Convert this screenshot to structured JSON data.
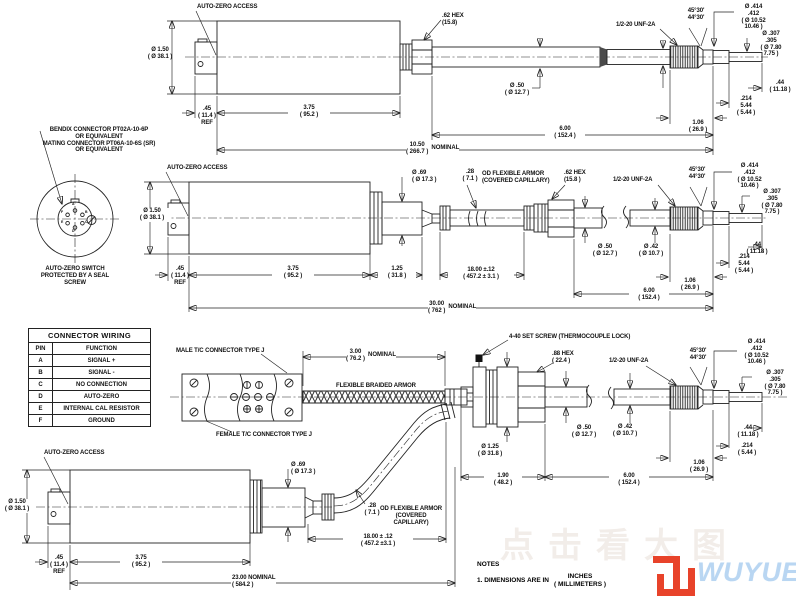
{
  "colors": {
    "line": "#222222",
    "logo_red": "#e8432a",
    "logo_blue": "#b9d6f2",
    "watermark": "#f2ede9"
  },
  "watermark": "点击看大图",
  "logo": {
    "brand": "WUYUE"
  },
  "detail": {
    "bendix": "BENDIX CONNECTOR PT02A-10-6P\nOR EQUIVALENT\nMATING CONNECTOR PT06A-10-6S (SR)\nOR EQUIVALENT",
    "caption": "AUTO-ZERO SWITCH\nPROTECTED BY A SEAL SCREW",
    "pins": [
      "A",
      "B",
      "C",
      "D",
      "E",
      "F"
    ]
  },
  "table": {
    "title": "CONNECTOR WIRING",
    "col_pin": "PIN",
    "col_function": "FUNCTION",
    "rows": [
      {
        "pin": "A",
        "fn": "SIGNAL +"
      },
      {
        "pin": "B",
        "fn": "SIGNAL -"
      },
      {
        "pin": "C",
        "fn": "NO CONNECTION"
      },
      {
        "pin": "D",
        "fn": "AUTO-ZERO"
      },
      {
        "pin": "E",
        "fn": "INTERNAL CAL RESISTOR"
      },
      {
        "pin": "F",
        "fn": "GROUND"
      }
    ]
  },
  "view1": {
    "auto_zero": "AUTO-ZERO ACCESS",
    "dia_body": "Ø 1.50\n( Ø 38.1 )",
    "ref": ".45\n( 11.4 )\nREF",
    "len_body": "3.75\n( 95.2 )",
    "hex": ".62 HEX\n(15.8)",
    "dia_50": "Ø .50\n( Ø 12.7 )",
    "thread": "1/2-20 UNF-2A",
    "dia_42": "Ø .42\n( Ø 10.7 )",
    "angle": "45°30'\n44°30'",
    "dia_tip_major": "Ø .414\n.412\n( Ø 10.52\n10.46 )",
    "dia_tip_minor": "Ø .307\n.305\n( Ø 7.80\n7.75 )",
    "len_tip": ".44\n( 11.18 )",
    "len_214": ".214\n5.44\n( 5.44 )",
    "len_thread": "1.06\n( 26.9 )",
    "len_probe": "6.00\n( 152.4 )",
    "total": "10.50\n( 266.7 )",
    "total_suffix": "NOMINAL"
  },
  "view2": {
    "auto_zero": "AUTO-ZERO ACCESS",
    "dia_body": "Ø 1.50\n( Ø 38.1 )",
    "ref": ".45\n( 11.4 )\nREF",
    "len_body": "3.75\n( 95.2 )",
    "len_adapter": "1.25\n( 31.8 )",
    "dia_adapter": "Ø .69\n( Ø 17.3 )",
    "armor_od": ".28\n( 7.1 )",
    "armor_label": "OD FLEXIBLE ARMOR\n(COVERED CAPILLARY)",
    "len_armor": "18.00 ±.12\n( 457.2 ± 3.1 )",
    "hex": ".62 HEX\n(15.8 )",
    "dia_50": "Ø .50\n( Ø 12.7 )",
    "thread": "1/2-20 UNF-2A",
    "dia_42": "Ø .42\n( Ø 10.7 )",
    "angle": "45°30'\n44°30'",
    "dia_tip_major": "Ø .414\n.412\n( Ø 10.52\n10.46 )",
    "dia_tip_minor": "Ø .307\n.305\n( Ø 7.80\n7.75 )",
    "len_tip": ".44\n( 11.18 )",
    "len_214": ".214\n5.44\n( 5.44 )",
    "len_thread": "1.06\n( 26.9 )",
    "len_probe": "6.00\n( 152.4 )",
    "total": "30.00\n( 762 )",
    "total_suffix": "NOMINAL"
  },
  "view3": {
    "male_tc": "MALE T/C CONNECTOR TYPE J",
    "female_tc": "FEMALE T/C CONNECTOR TYPE J",
    "braid_len": "3.00\n( 76.2 )",
    "braid_suffix": "NOMINAL",
    "braid_label": "FLEXIBLE BRAIDED ARMOR",
    "set_screw": "4-40 SET SCREW (THERMOCOUPLE LOCK)",
    "hex": ".88 HEX\n( 22.4 )",
    "thread": "1/2-20 UNF-2A",
    "angle": "45°30'\n44°30'",
    "dia_tip_major": "Ø .414\n.412\n( Ø 10.52\n10.46 )",
    "dia_tip_minor": "Ø .307\n.305\n( Ø 7.80\n7.75 )",
    "dia_50": "Ø .50\n( Ø 12.7 )",
    "dia_42": "Ø .42\n( Ø 10.7 )",
    "dia_flange": "Ø 1.25\n( Ø 31.8 )",
    "len_tip": ".44\n( 11.18 )",
    "len_214": ".214\n( 5.44 )",
    "len_thread": "1.06\n( 26.9 )",
    "len_190": "1.90\n( 48.2 )",
    "len_probe": "6.00\n( 152.4 )"
  },
  "view4": {
    "auto_zero": "AUTO-ZERO ACCESS",
    "dia_body": "Ø 1.50\n( Ø 38.1 )",
    "ref": ".45\n( 11.4 )\nREF",
    "len_body": "3.75\n( 95.2 )",
    "dia_adapter": "Ø .69\n( Ø 17.3 )",
    "armor_od": ".28\n( 7.1 )",
    "armor_label": "OD FLEXIBLE ARMOR\n(COVERED CAPILLARY)",
    "len_armor": "18.00 ± .12\n( 457.2 ±3.1 )",
    "total": "23.00  NOMINAL\n( 584.2 )"
  },
  "notes": {
    "title": "NOTES",
    "line1": "1. DIMENSIONS ARE IN",
    "units_top": "INCHES",
    "units_bottom": "( MILLIMETERS )"
  }
}
